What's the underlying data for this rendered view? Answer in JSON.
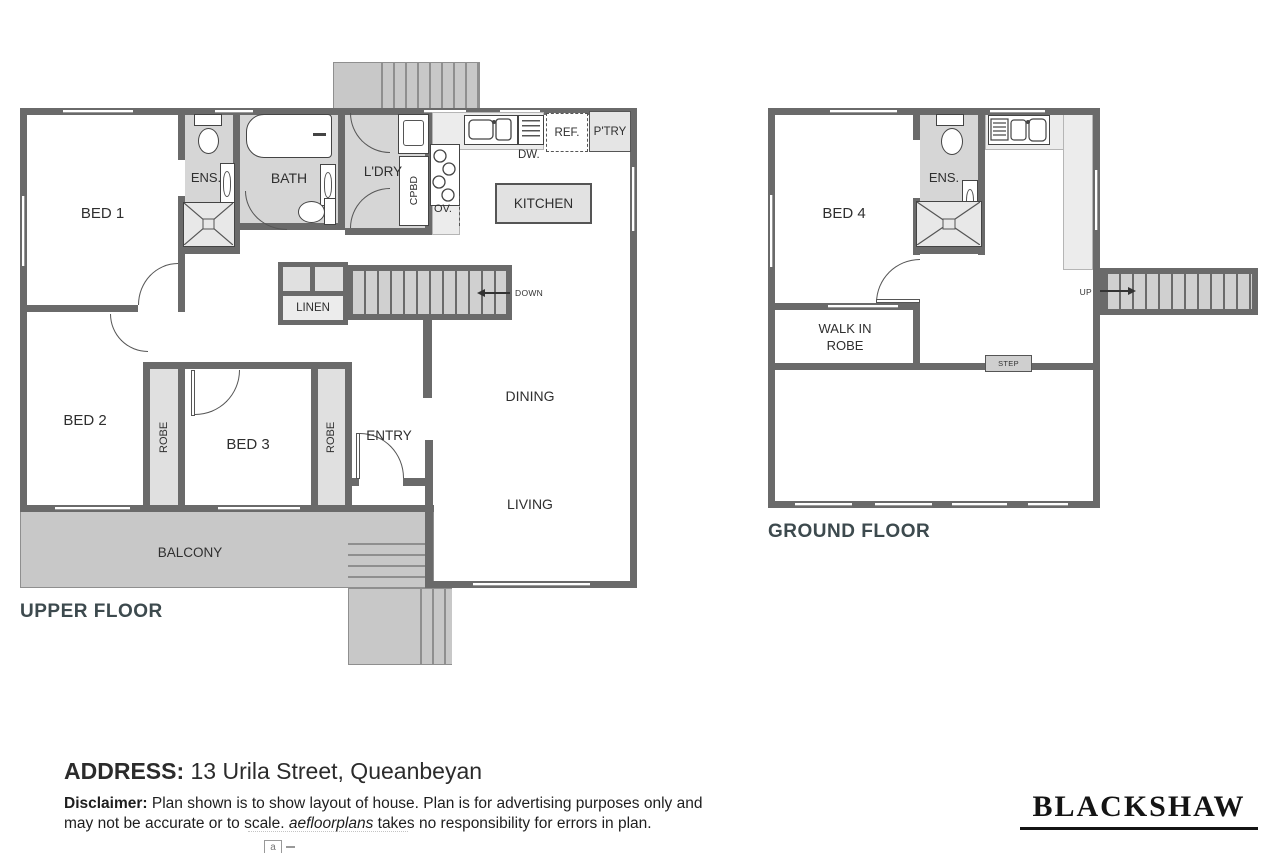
{
  "upper": {
    "title": "UPPER FLOOR",
    "bed1": "BED 1",
    "bed2": "BED 2",
    "bed3": "BED 3",
    "ens": "ENS.",
    "bath": "BATH",
    "ldry": "L'DRY",
    "cpbd": "CPBD",
    "kitchen": "KITCHEN",
    "ov": "OV.",
    "dw": "DW.",
    "ref": "REF.",
    "ptry": "P'TRY",
    "linen": "LINEN",
    "down": "DOWN",
    "robe_left": "ROBE",
    "robe_right": "ROBE",
    "entry": "ENTRY",
    "dining": "DINING",
    "living": "LIVING",
    "balcony": "BALCONY"
  },
  "ground": {
    "title": "GROUND FLOOR",
    "bed4": "BED 4",
    "ens": "ENS.",
    "wir_line1": "WALK IN",
    "wir_line2": "ROBE",
    "step": "STEP",
    "up": "UP"
  },
  "footer": {
    "address_label": "ADDRESS:",
    "address_value": " 13 Urila Street, Queanbeyan",
    "disclaimer_label": "Disclaimer:",
    "disclaimer_part1": " Plan shown is to show layout of house. Plan is for advertising purposes only and may not be accurate or to scale. ",
    "disclaimer_italic": "aefloorplans",
    "disclaimer_part2": " takes no responsibility for errors in plan.",
    "brand": "BLACKSHAW",
    "logo_fragment": "a"
  },
  "colors": {
    "wall": "#6a6a6a",
    "wet_room": "#d6d6d6",
    "deck": "#c8c8c8",
    "title_text": "#3d4a4e"
  }
}
